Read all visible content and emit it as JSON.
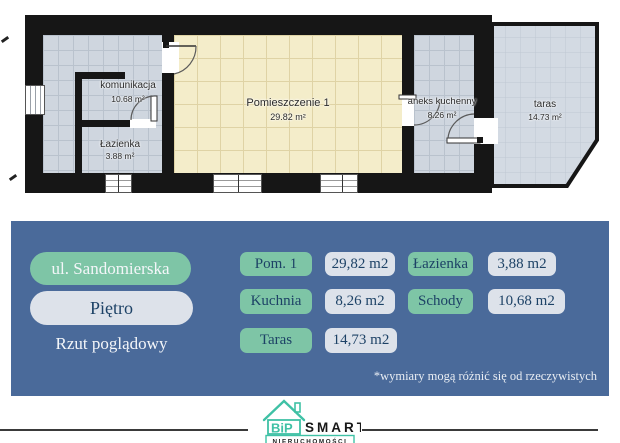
{
  "plan": {
    "rooms": {
      "komunikacja": {
        "label": "komunikacja",
        "area": "10.68 m²"
      },
      "lazienka": {
        "label": "Łazienka",
        "area": "3.88 m²"
      },
      "pomieszczenie1": {
        "label": "Pomieszczenie 1",
        "area": "29.82 m²"
      },
      "aneks": {
        "label": "aneks kuchenny",
        "area": "8.26 m²"
      },
      "taras": {
        "label": "taras",
        "area": "14.73 m²"
      }
    }
  },
  "panel": {
    "address": "ul. Sandomierska",
    "floor": "Piętro",
    "view_label": "Rzut poglądowy",
    "table": {
      "rows": [
        {
          "name": "Pom. 1",
          "value": "29,82 m2"
        },
        {
          "name": "Łazienka",
          "value": "3,88 m2"
        },
        {
          "name": "Kuchnia",
          "value": "8,26 m2"
        },
        {
          "name": "Schody",
          "value": "10,68 m2"
        },
        {
          "name": "Taras",
          "value": "14,73 m2"
        }
      ]
    },
    "disclaimer": "*wymiary mogą różnić się od rzeczywistych"
  },
  "footer": {
    "logo": {
      "monogram": "BiP",
      "brand": "SMART",
      "subtitle": "NIERUCHOMOŚCI"
    }
  },
  "colors": {
    "panel_blue": "#4a6a9a",
    "pill_green": "#7ec5a6",
    "pill_light": "#dde2ea",
    "text_navy": "#1d4266",
    "floor_cream": "#f4edca",
    "floor_gray": "#cfd6df",
    "taras_fill": "#d3dae3",
    "wall_black": "#161616",
    "logo_teal": "#3fc1a5"
  }
}
